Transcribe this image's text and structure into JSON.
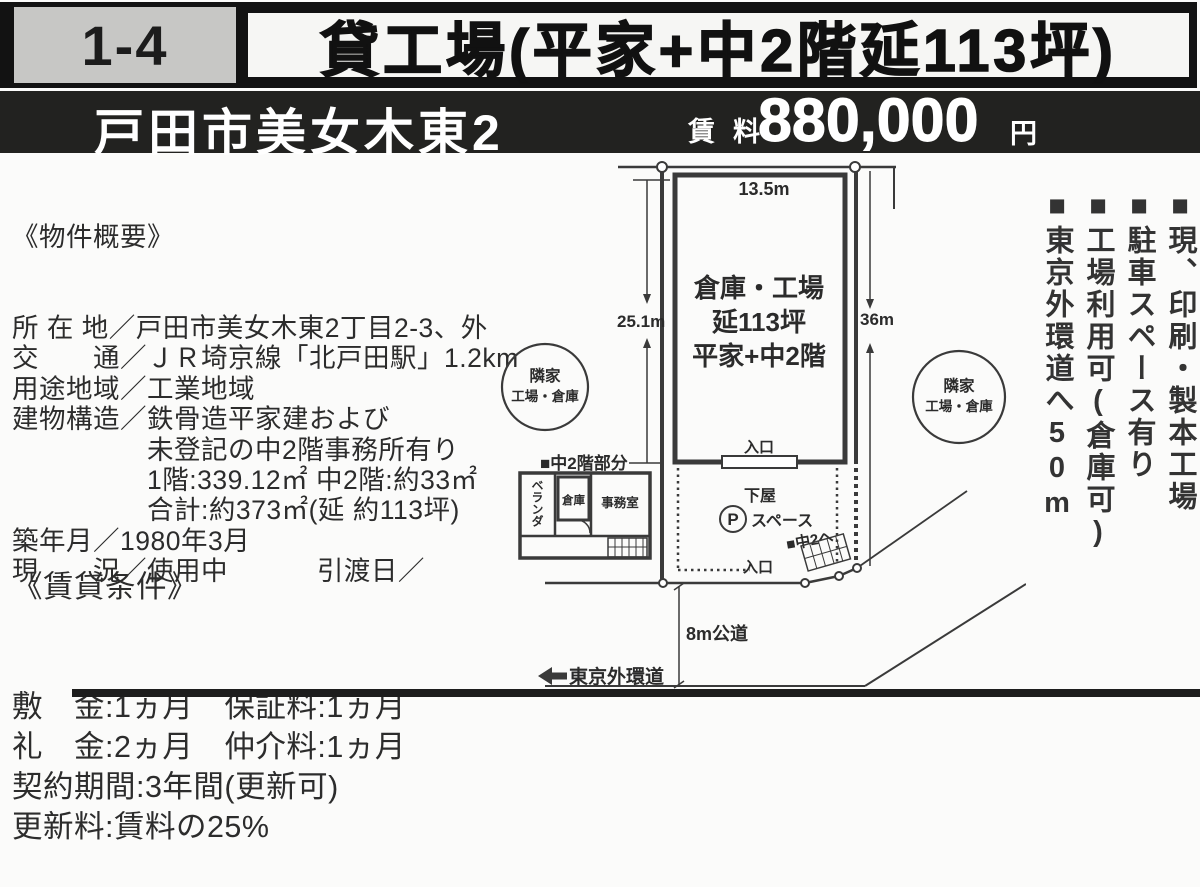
{
  "header": {
    "code": "1-4",
    "title": "貸工場(平家+中2階延113坪)"
  },
  "subheader": {
    "location": "戸田市美女木東2",
    "rent_label_1": "賃",
    "rent_label_2": "料",
    "rent_amount": "880,000",
    "rent_unit": "円"
  },
  "overview": {
    "heading": "《物件概要》",
    "lines": [
      "所 在 地／戸田市美女木東2丁目2-3、外",
      "交　　通／ＪＲ埼京線「北戸田駅」1.2km",
      "用途地域／工業地域",
      "建物構造／鉄骨造平家建および",
      "　　　　　未登記の中2階事務所有り",
      "　　　　　1階:339.12㎡ 中2階:約33㎡",
      "　　　　　合計:約373㎡(延 約113坪)",
      "築年月／1980年3月",
      "現　　況／使用中　　　 引渡日／"
    ]
  },
  "conditions": {
    "heading": "《賃貸条件》",
    "lines": [
      "敷　金:1ヵ月　保証料:1ヵ月",
      "礼　金:2ヵ月　仲介料:1ヵ月",
      "契約期間:3年間(更新可)",
      "更新料:賃料の25%"
    ]
  },
  "features": [
    "■現、印刷・製本工場",
    "■駐車スペース有り",
    "■工場利用可(倉庫可)",
    "■東京外環道へ50m"
  ],
  "diagram": {
    "building_width": "13.5m",
    "left_dimension": "25.1m",
    "right_dimension": "36m",
    "building_line1": "倉庫・工場",
    "building_line2": "延113坪",
    "building_line3": "平家+中2階",
    "entrance_top": "入口",
    "entrance_bottom": "入口",
    "mezzanine_label": "■中2階部分",
    "veranda": "ベランダ",
    "storage": "倉庫",
    "office": "事務室",
    "lower_roof": "下屋",
    "parking_symbol": "P",
    "parking_space": "スペース",
    "to_mezzanine": "■中2へ",
    "road": "8m公道",
    "outer_road": "東京外環道",
    "neighbor_line1": "隣家",
    "neighbor_line2": "工場・倉庫"
  }
}
